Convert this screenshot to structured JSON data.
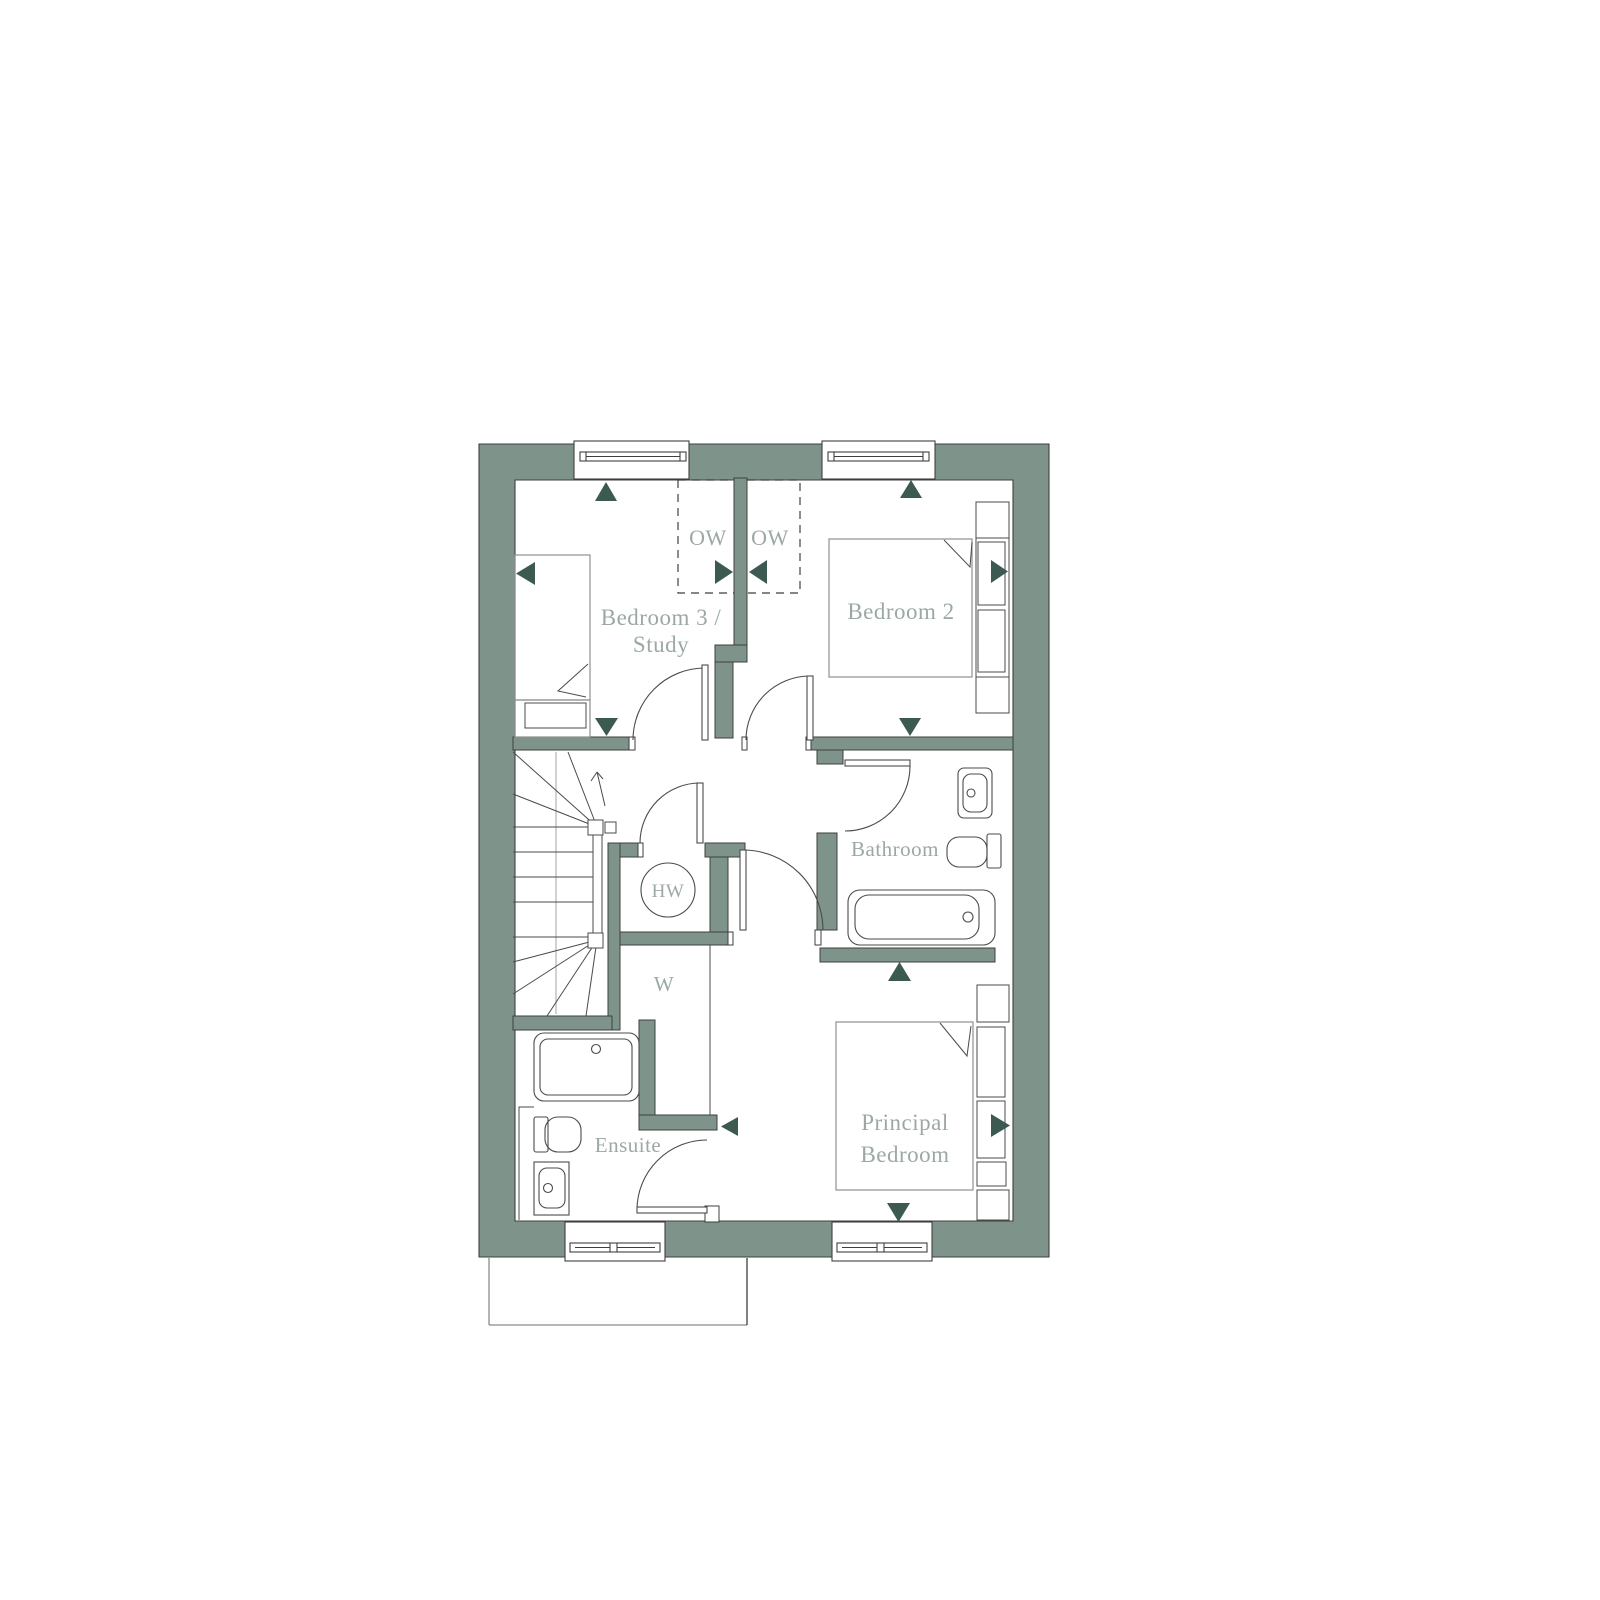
{
  "plan": {
    "labels": {
      "bedroom3_line1": "Bedroom 3 /",
      "bedroom3_line2": "Study",
      "bedroom2": "Bedroom 2",
      "ow_left": "OW",
      "ow_right": "OW",
      "bathroom": "Bathroom",
      "hot_water": "HW",
      "wardrobe": "W",
      "ensuite": "Ensuite",
      "principal_line1": "Principal",
      "principal_line2": "Bedroom"
    },
    "colors": {
      "wall_fill": "#7E948B",
      "arrow_fill": "#3C5A51",
      "label_text": "#9CA9A3",
      "outline": "#3F3F3F",
      "bed_line": "#8F8F8F",
      "fixture_line": "#4B4B4B",
      "stair_guide": "#BBC0BC",
      "footprint_line": "#8B8B8B"
    }
  }
}
